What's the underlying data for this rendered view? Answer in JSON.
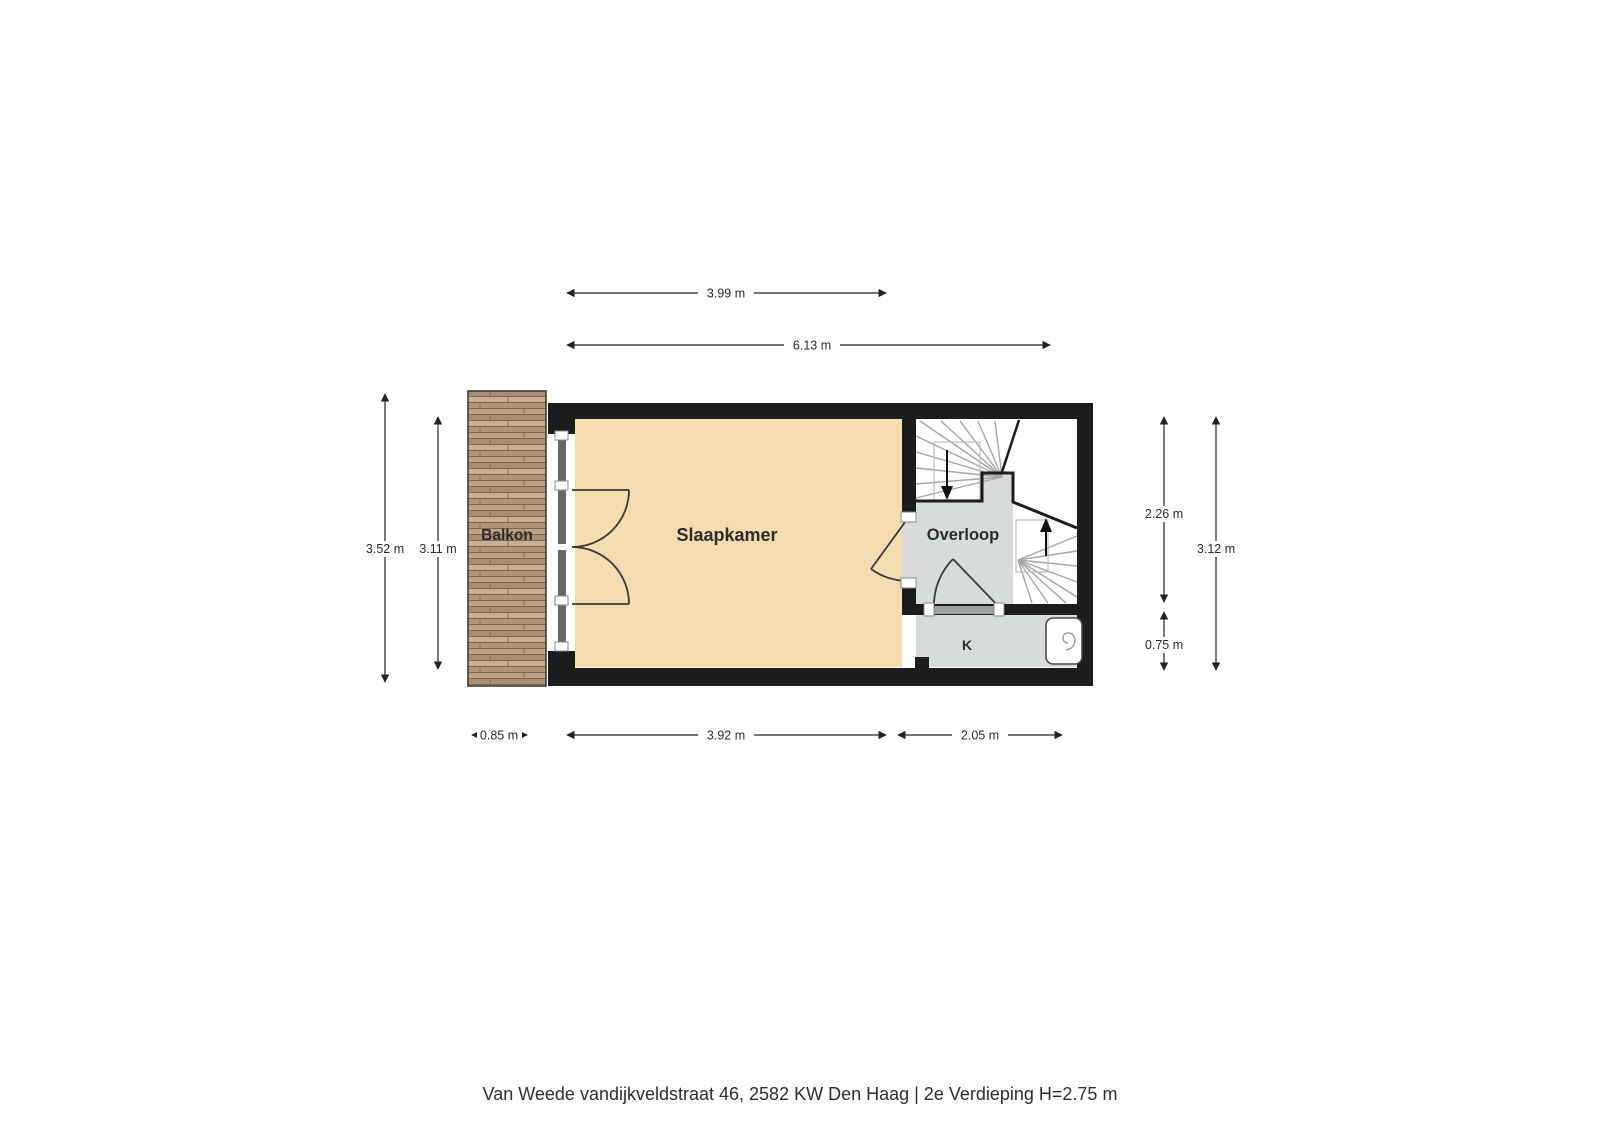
{
  "footer": {
    "caption": "Van Weede vandijkveldstraat 46, 2582 KW Den Haag | 2e Verdieping H=2.75 m"
  },
  "rooms": {
    "balkon": {
      "label": "Balkon"
    },
    "slaapkamer": {
      "label": "Slaapkamer"
    },
    "overloop": {
      "label": "Overloop"
    },
    "kast": {
      "label": "K"
    }
  },
  "dimensions": {
    "top_bedroom_width": {
      "label": "3.99 m"
    },
    "top_total_width": {
      "label": "6.13 m"
    },
    "left_balcony_height": {
      "label": "3.52 m"
    },
    "left_interior_height": {
      "label": "3.11 m"
    },
    "right_upper_height": {
      "label": "2.26 m"
    },
    "right_lower_height": {
      "label": "0.75 m"
    },
    "right_total_height": {
      "label": "3.12 m"
    },
    "bottom_balcony_width": {
      "label": "0.85 m"
    },
    "bottom_bedroom_width": {
      "label": "3.92 m"
    },
    "bottom_hall_width": {
      "label": "2.05 m"
    }
  },
  "icons": {
    "stairs_down": "stairs-down-arrow",
    "stairs_up": "stairs-up-arrow",
    "boiler": "water-heater-boiler"
  },
  "colors": {
    "wall": "#1c1c1c",
    "bedroom_floor": "#f3ddb0",
    "hall_floor": "#d8dcd9",
    "threshold": "#9aa3a2",
    "stair_tread": "#a6a6a6",
    "walk_line": "#bdbdbd",
    "door_arc": "#3a3a3a",
    "dim_line": "#222222",
    "room_label": "#2d2d2d",
    "glass": "#676767",
    "wood_a": "#bda186",
    "wood_b": "#a98e74",
    "wood_c": "#c7ae95",
    "wood_d": "#b09677",
    "wood_gap": "#7e6852",
    "balcony_border": "#3c3c3c"
  }
}
